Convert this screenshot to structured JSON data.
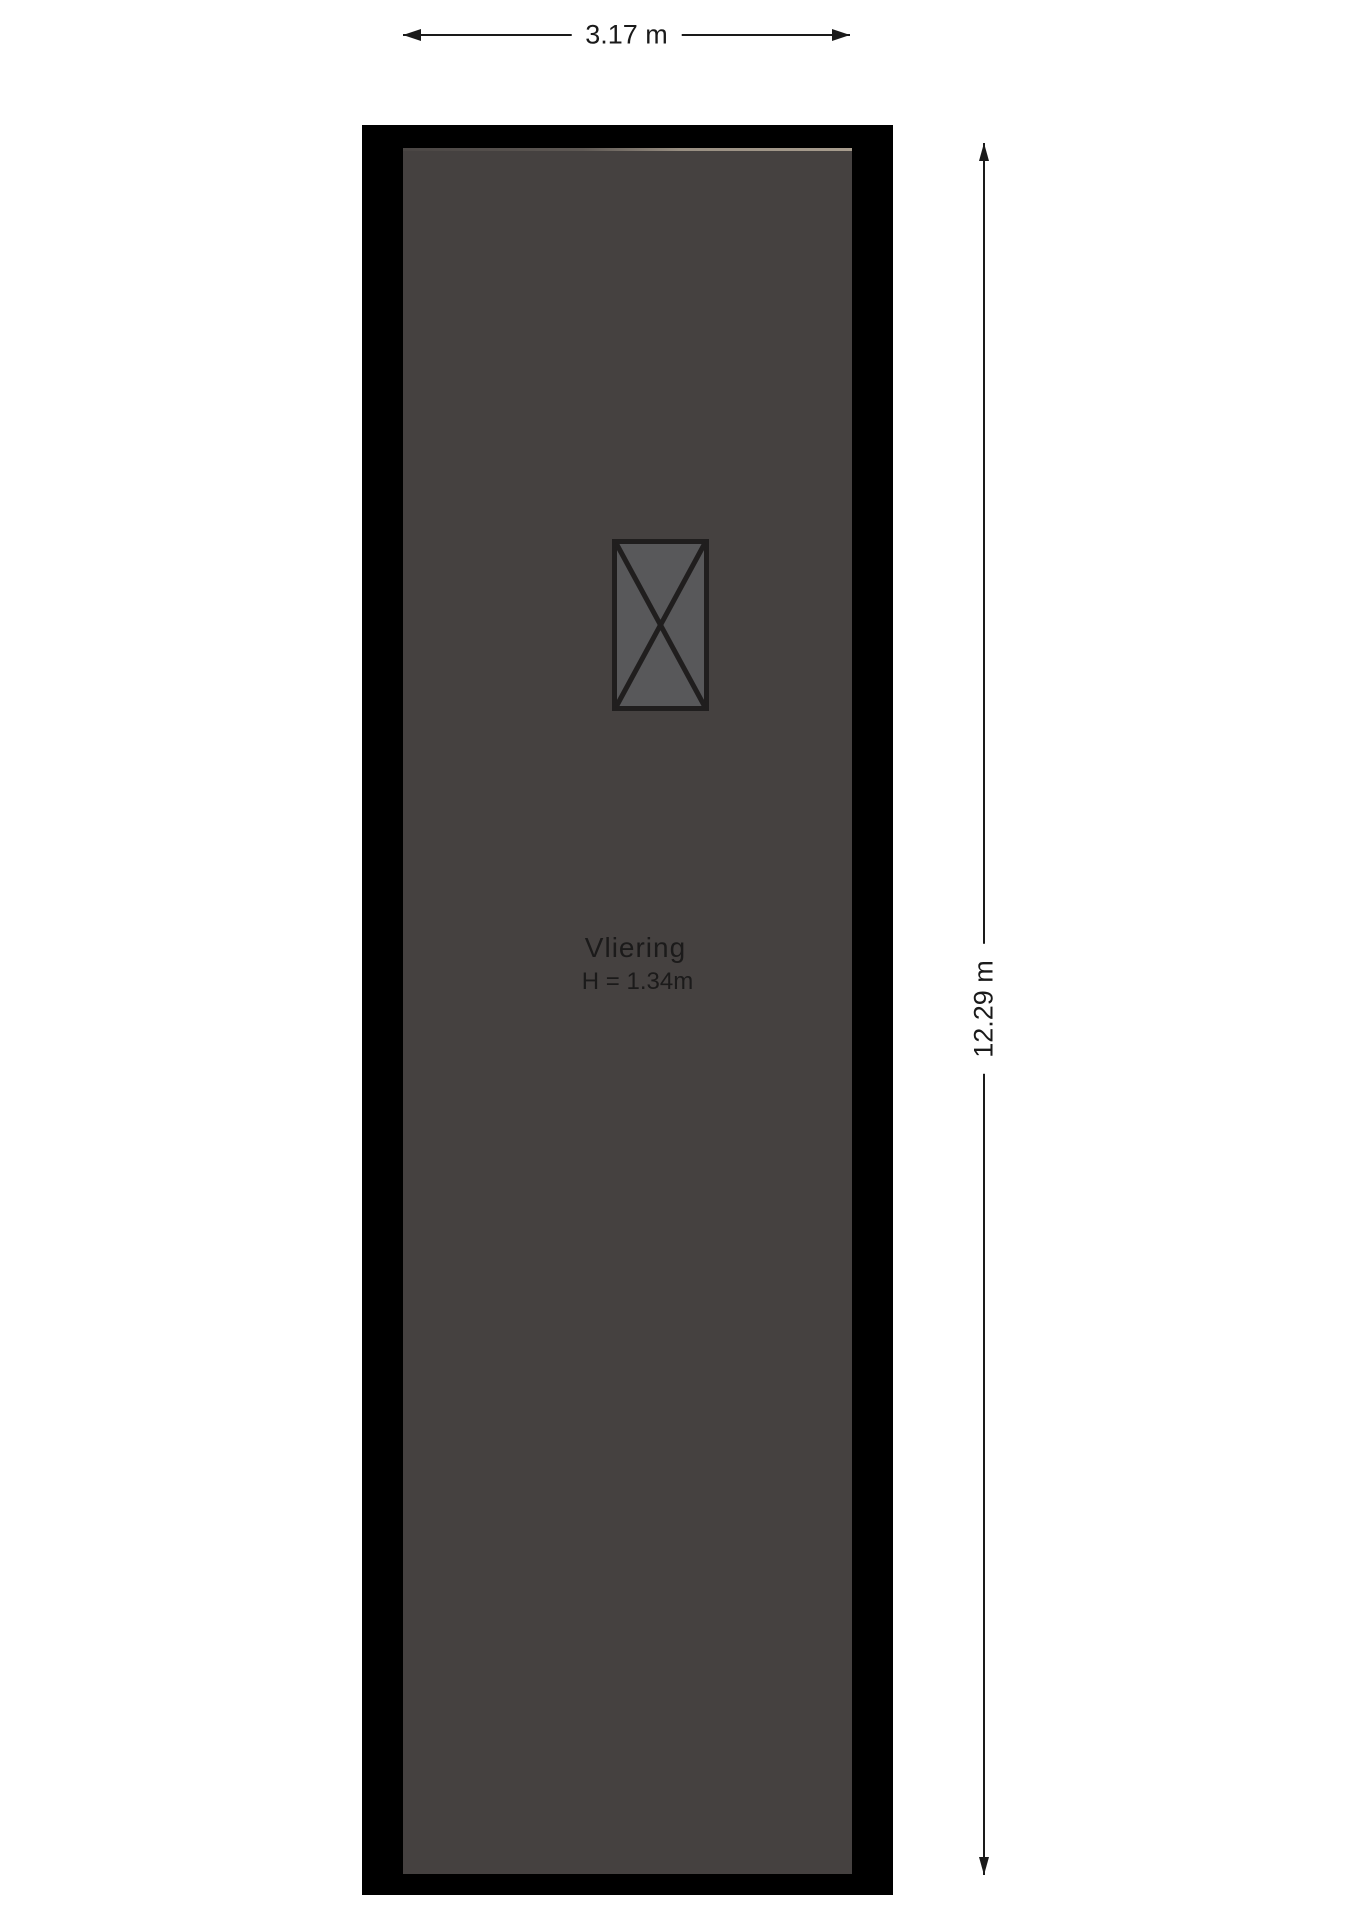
{
  "floorplan": {
    "room": {
      "name": "Vliering",
      "ceiling_height_label": "H = 1.34m"
    },
    "dimensions": {
      "width": {
        "label": "3.17 m"
      },
      "depth": {
        "label": "12.29 m"
      }
    },
    "symbols": [
      {
        "name": "stair-hatch",
        "type": "x-crossed-rectangle"
      }
    ],
    "colors": {
      "background": "#FFFFFF",
      "wall": "#000000",
      "floor": "#454140",
      "floor_edge_highlight": "#A89D8E",
      "stair_fill": "#58585A",
      "stair_stroke": "#201E1E",
      "dimension_line": "#1A1A1A",
      "label_text": "#1B1A1A"
    }
  }
}
